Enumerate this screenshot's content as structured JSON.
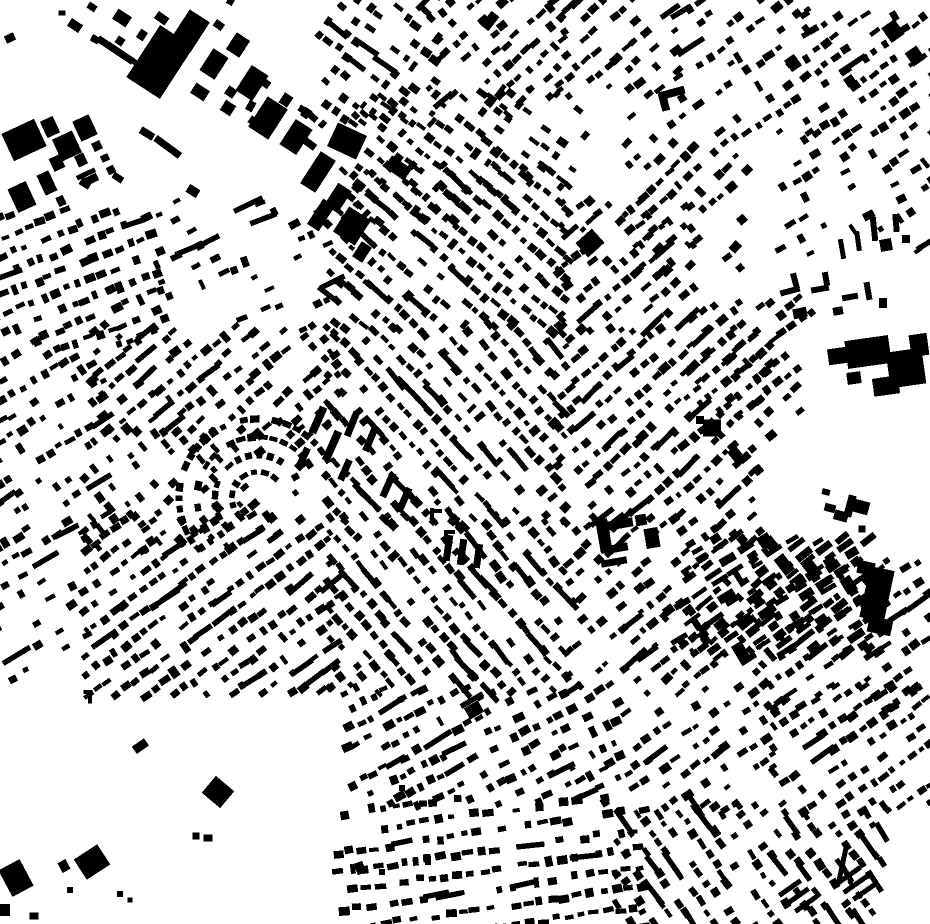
{
  "canvas": {
    "width": 930,
    "height": 924
  },
  "colors": {
    "background": "#ffffff",
    "building": "#000000"
  },
  "map": {
    "seed": 1337,
    "defaults": {
      "sx": 12,
      "sy": 17,
      "bw": 8,
      "bh": 6,
      "density": 0.8,
      "bar": 0.05,
      "cross": 0.08,
      "jit": 2.2,
      "ajit": 10
    },
    "districts": [
      {
        "name": "nw-industrial-fill",
        "x": 64,
        "y": 0,
        "w": 250,
        "h": 225,
        "angle": 33,
        "sx": 24,
        "sy": 26,
        "bw": 11,
        "bh": 8,
        "density": 0.22,
        "bar": 0.1
      },
      {
        "name": "n-block-a",
        "x": 315,
        "y": 0,
        "w": 125,
        "h": 125,
        "angle": 38,
        "density": 0.7
      },
      {
        "name": "n-block-b",
        "x": 430,
        "y": 0,
        "w": 130,
        "h": 105,
        "angle": -42,
        "density": 0.6
      },
      {
        "name": "n-block-c",
        "x": 355,
        "y": 95,
        "w": 155,
        "h": 125,
        "angle": 40,
        "density": 0.8
      },
      {
        "name": "ne-block-a",
        "x": 555,
        "y": 0,
        "w": 120,
        "h": 95,
        "angle": -40,
        "density": 0.55
      },
      {
        "name": "ne-block-b",
        "x": 675,
        "y": 0,
        "w": 135,
        "h": 130,
        "angle": -35,
        "density": 0.5
      },
      {
        "name": "ne-corner",
        "x": 808,
        "y": 15,
        "w": 122,
        "h": 145,
        "angle": -35,
        "density": 0.65
      },
      {
        "name": "ne-mid",
        "x": 628,
        "y": 118,
        "w": 115,
        "h": 150,
        "angle": -42,
        "density": 0.6
      },
      {
        "name": "nw-grid",
        "x": 0,
        "y": 213,
        "w": 160,
        "h": 130,
        "angle": -22,
        "density": 0.9,
        "sx": 12.5,
        "sy": 18
      },
      {
        "name": "nw-thin",
        "x": 160,
        "y": 205,
        "w": 170,
        "h": 125,
        "angle": -24,
        "density": 0.3
      },
      {
        "name": "w-band",
        "x": 0,
        "y": 343,
        "w": 100,
        "h": 185,
        "angle": -32,
        "density": 0.55
      },
      {
        "name": "c-nw",
        "x": 95,
        "y": 328,
        "w": 240,
        "h": 105,
        "angle": -40,
        "density": 0.8
      },
      {
        "name": "c-main-a",
        "x": 330,
        "y": 168,
        "w": 235,
        "h": 160,
        "angle": 42,
        "density": 0.85
      },
      {
        "name": "c-main-b",
        "x": 328,
        "y": 328,
        "w": 230,
        "h": 195,
        "angle": 48,
        "density": 0.78,
        "bar": 0.1
      },
      {
        "name": "c-e",
        "x": 558,
        "y": 205,
        "w": 135,
        "h": 125,
        "angle": -40,
        "density": 0.75
      },
      {
        "name": "e-band",
        "x": 558,
        "y": 330,
        "w": 215,
        "h": 190,
        "angle": -42,
        "density": 0.78,
        "bar": 0.09
      },
      {
        "name": "crescent-fill",
        "x": 195,
        "y": 420,
        "w": 115,
        "h": 105,
        "angle": -40,
        "density": 0.12
      },
      {
        "name": "w-mid",
        "x": 88,
        "y": 432,
        "w": 155,
        "h": 120,
        "angle": 50,
        "density": 0.45
      },
      {
        "name": "sw-band",
        "x": 0,
        "y": 528,
        "w": 88,
        "h": 150,
        "angle": -30,
        "density": 0.3
      },
      {
        "name": "c-sw",
        "x": 85,
        "y": 518,
        "w": 250,
        "h": 175,
        "angle": -36,
        "density": 0.85
      },
      {
        "name": "c-s",
        "x": 330,
        "y": 520,
        "w": 235,
        "h": 172,
        "angle": 50,
        "density": 0.78,
        "bar": 0.1
      },
      {
        "name": "se-mid",
        "x": 568,
        "y": 520,
        "w": 200,
        "h": 172,
        "angle": -40,
        "density": 0.7
      },
      {
        "name": "e-edge",
        "x": 772,
        "y": 562,
        "w": 158,
        "h": 146,
        "angle": -35,
        "density": 0.68
      },
      {
        "name": "commercial-strip",
        "x": 682,
        "y": 538,
        "w": 185,
        "h": 118,
        "angle": 55,
        "sx": 9,
        "sy": 21,
        "bw": 6,
        "bh": 13,
        "density": 0.88,
        "bar": 0.03,
        "cross": 0.03
      },
      {
        "name": "s-center-a",
        "x": 348,
        "y": 690,
        "w": 270,
        "h": 112,
        "angle": -28,
        "density": 0.72
      },
      {
        "name": "s-center-b",
        "x": 338,
        "y": 802,
        "w": 305,
        "h": 122,
        "angle": -8,
        "density": 0.8,
        "sx": 13,
        "sy": 19
      },
      {
        "name": "se-a",
        "x": 622,
        "y": 700,
        "w": 150,
        "h": 108,
        "angle": -35,
        "density": 0.55
      },
      {
        "name": "se-b",
        "x": 620,
        "y": 808,
        "w": 260,
        "h": 116,
        "angle": 55,
        "density": 0.8,
        "bar": 0.12
      },
      {
        "name": "se-c",
        "x": 775,
        "y": 690,
        "w": 155,
        "h": 122,
        "angle": -35,
        "density": 0.72
      },
      {
        "name": "right-upper",
        "x": 780,
        "y": 165,
        "w": 150,
        "h": 85,
        "angle": -30,
        "density": 0.35
      },
      {
        "name": "mid-right",
        "x": 692,
        "y": 300,
        "w": 118,
        "h": 112,
        "angle": -40,
        "density": 0.6
      },
      {
        "name": "n-mid-fill",
        "x": 498,
        "y": 92,
        "w": 85,
        "h": 92,
        "angle": 40,
        "density": 0.5
      },
      {
        "name": "sw-rural",
        "x": 0,
        "y": 700,
        "w": 348,
        "h": 224,
        "angle": -30,
        "sx": 42,
        "sy": 44,
        "bw": 11,
        "bh": 9,
        "density": 0.06
      }
    ],
    "arcs": [
      {
        "cx": 258,
        "cy": 498,
        "radii": [
          26,
          43,
          61,
          79
        ],
        "t0": 140,
        "t1": 335,
        "pitch": 11,
        "bw": 8,
        "bh": 6,
        "density": 0.85
      }
    ],
    "landmarks": [
      [
        24,
        140,
        36,
        30,
        -25
      ],
      [
        50,
        127,
        14,
        18,
        -25
      ],
      [
        67,
        146,
        22,
        24,
        -25
      ],
      [
        85,
        128,
        18,
        22,
        -25
      ],
      [
        57,
        163,
        12,
        14,
        -25
      ],
      [
        47,
        183,
        13,
        22,
        -25
      ],
      [
        22,
        197,
        20,
        26,
        -25
      ],
      [
        81,
        160,
        10,
        12,
        -25
      ],
      [
        97,
        146,
        9,
        9,
        -25
      ],
      [
        105,
        158,
        8,
        7,
        -25
      ],
      [
        92,
        179,
        12,
        8,
        -25
      ],
      [
        61,
        201,
        8,
        10,
        -25
      ],
      [
        111,
        170,
        8,
        8,
        -25
      ],
      [
        86,
        174,
        20,
        5,
        -25
      ],
      [
        10,
        38,
        10,
        8,
        -25
      ],
      [
        92,
        7,
        9,
        7,
        33
      ],
      [
        62,
        13,
        7,
        5,
        0
      ],
      [
        122,
        18,
        16,
        12,
        33
      ],
      [
        160,
        62,
        40,
        62,
        33
      ],
      [
        190,
        31,
        24,
        36,
        33
      ],
      [
        214,
        64,
        18,
        26,
        33
      ],
      [
        238,
        45,
        16,
        20,
        33
      ],
      [
        200,
        92,
        16,
        12,
        33
      ],
      [
        252,
        83,
        20,
        30,
        33
      ],
      [
        228,
        108,
        12,
        12,
        33
      ],
      [
        268,
        118,
        24,
        36,
        33
      ],
      [
        296,
        137,
        20,
        30,
        33
      ],
      [
        318,
        172,
        18,
        38,
        33
      ],
      [
        338,
        198,
        16,
        26,
        33
      ],
      [
        352,
        226,
        26,
        30,
        33
      ],
      [
        362,
        252,
        12,
        18,
        33
      ],
      [
        286,
        100,
        10,
        12,
        33
      ],
      [
        306,
        113,
        8,
        10,
        33
      ],
      [
        253,
        121,
        8,
        8,
        33
      ],
      [
        347,
        141,
        32,
        26,
        25
      ],
      [
        398,
        168,
        24,
        14,
        35
      ],
      [
        321,
        215,
        14,
        30,
        33
      ],
      [
        120,
        41,
        8,
        8,
        33
      ],
      [
        142,
        35,
        8,
        10,
        33
      ],
      [
        490,
        21,
        10,
        18,
        38
      ],
      [
        793,
        63,
        12,
        14,
        -35
      ],
      [
        850,
        81,
        10,
        10,
        -35
      ],
      [
        893,
        31,
        16,
        18,
        -35
      ],
      [
        915,
        56,
        14,
        16,
        -35
      ],
      [
        672,
        93,
        26,
        8,
        -15
      ],
      [
        664,
        102,
        8,
        18,
        -15
      ],
      [
        842,
        249,
        5,
        20,
        -10
      ],
      [
        858,
        241,
        5,
        20,
        -8
      ],
      [
        874,
        229,
        6,
        24,
        -6
      ],
      [
        886,
        245,
        12,
        12,
        -10
      ],
      [
        896,
        223,
        6,
        18,
        -5
      ],
      [
        906,
        239,
        8,
        8,
        0
      ],
      [
        790,
        291,
        20,
        6,
        -15
      ],
      [
        795,
        281,
        6,
        16,
        -15
      ],
      [
        820,
        289,
        18,
        6,
        -10
      ],
      [
        826,
        279,
        6,
        14,
        -10
      ],
      [
        850,
        297,
        16,
        6,
        -10
      ],
      [
        868,
        291,
        6,
        18,
        -10
      ],
      [
        838,
        311,
        10,
        8,
        -10
      ],
      [
        800,
        313,
        14,
        10,
        -12
      ],
      [
        883,
        303,
        8,
        10,
        0
      ],
      [
        868,
        352,
        44,
        28,
        -8
      ],
      [
        906,
        368,
        36,
        36,
        -8
      ],
      [
        838,
        356,
        20,
        16,
        -8
      ],
      [
        886,
        386,
        26,
        18,
        -8
      ],
      [
        919,
        345,
        18,
        22,
        -8
      ],
      [
        854,
        378,
        14,
        12,
        -8
      ],
      [
        590,
        243,
        22,
        19,
        -42
      ],
      [
        570,
        232,
        20,
        5,
        -42
      ],
      [
        607,
        261,
        8,
        8,
        -42
      ],
      [
        712,
        428,
        18,
        17,
        0
      ],
      [
        700,
        420,
        8,
        8,
        0
      ],
      [
        737,
        456,
        11,
        18,
        -40
      ],
      [
        758,
        470,
        9,
        9,
        -40
      ],
      [
        826,
        492,
        8,
        6,
        15
      ],
      [
        830,
        508,
        11,
        8,
        15
      ],
      [
        841,
        516,
        14,
        10,
        15
      ],
      [
        850,
        506,
        8,
        22,
        15
      ],
      [
        861,
        507,
        16,
        13,
        15
      ],
      [
        862,
        529,
        7,
        7,
        0
      ],
      [
        877,
        594,
        25,
        52,
        12
      ],
      [
        866,
        568,
        17,
        13,
        12
      ],
      [
        880,
        626,
        24,
        16,
        12
      ],
      [
        604,
        536,
        12,
        34,
        -10
      ],
      [
        620,
        524,
        26,
        9,
        -10
      ],
      [
        618,
        548,
        20,
        8,
        -10
      ],
      [
        641,
        520,
        11,
        11,
        -10
      ],
      [
        652,
        538,
        14,
        20,
        -10
      ],
      [
        614,
        562,
        26,
        7,
        -10
      ],
      [
        318,
        420,
        8,
        28,
        24
      ],
      [
        332,
        446,
        8,
        32,
        24
      ],
      [
        352,
        424,
        7,
        26,
        22
      ],
      [
        303,
        458,
        7,
        22,
        25
      ],
      [
        345,
        470,
        7,
        22,
        24
      ],
      [
        370,
        440,
        7,
        24,
        23
      ],
      [
        388,
        485,
        7,
        26,
        24
      ],
      [
        404,
        500,
        7,
        26,
        24
      ],
      [
        448,
        548,
        7,
        26,
        8
      ],
      [
        462,
        552,
        7,
        26,
        8
      ],
      [
        478,
        556,
        7,
        24,
        8
      ],
      [
        474,
        710,
        16,
        13,
        -30
      ],
      [
        432,
        515,
        4,
        14,
        0
      ],
      [
        437,
        511,
        10,
        4,
        0
      ],
      [
        446,
        536,
        4,
        12,
        0
      ],
      [
        451,
        532,
        8,
        4,
        0
      ],
      [
        218,
        792,
        24,
        22,
        40
      ],
      [
        196,
        836,
        7,
        7,
        0
      ],
      [
        208,
        838,
        9,
        7,
        0
      ],
      [
        16,
        878,
        24,
        30,
        -28
      ],
      [
        64,
        866,
        9,
        11,
        -28
      ],
      [
        92,
        862,
        28,
        24,
        -33
      ],
      [
        70,
        890,
        6,
        6,
        0
      ],
      [
        120,
        894,
        6,
        6,
        0
      ],
      [
        130,
        900,
        5,
        5,
        0
      ],
      [
        360,
        868,
        9,
        12,
        -20
      ],
      [
        382,
        872,
        6,
        6,
        0
      ],
      [
        428,
        862,
        6,
        6,
        0
      ],
      [
        394,
        780,
        8,
        9,
        -20
      ],
      [
        402,
        788,
        6,
        6,
        0
      ],
      [
        88,
        692,
        9,
        4,
        0
      ],
      [
        90,
        698,
        4,
        11,
        0
      ],
      [
        4,
        910,
        12,
        12,
        0
      ],
      [
        34,
        916,
        9,
        7,
        0
      ],
      [
        843,
        862,
        5,
        40,
        12
      ],
      [
        790,
        888,
        5,
        26,
        55
      ],
      [
        798,
        896,
        5,
        26,
        55
      ],
      [
        806,
        904,
        5,
        26,
        55
      ],
      [
        848,
        876,
        5,
        30,
        55
      ],
      [
        856,
        884,
        5,
        30,
        55
      ],
      [
        864,
        892,
        5,
        26,
        55
      ]
    ]
  }
}
